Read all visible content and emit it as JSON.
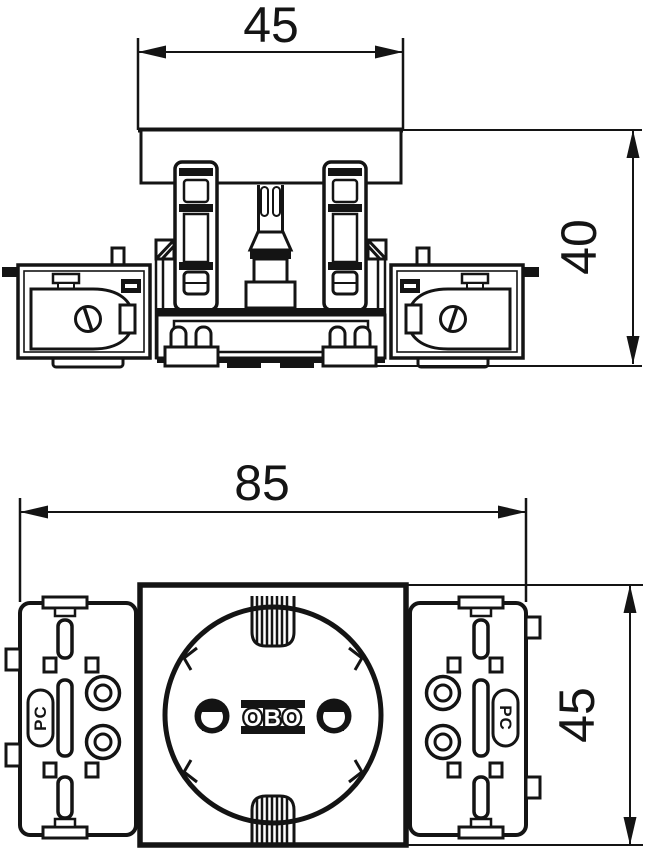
{
  "drawing": {
    "type": "technical-dimension-drawing",
    "colors": {
      "line": "#141414",
      "background": "#ffffff"
    },
    "side_view": {
      "name": "side elevation of socket module",
      "width_dim": "45",
      "height_dim": "40"
    },
    "front_view": {
      "name": "front view of socket module",
      "width_dim": "85",
      "height_dim": "45",
      "socket_logo": "OBO",
      "left_module_label": "PC",
      "right_module_label": "PC"
    }
  }
}
